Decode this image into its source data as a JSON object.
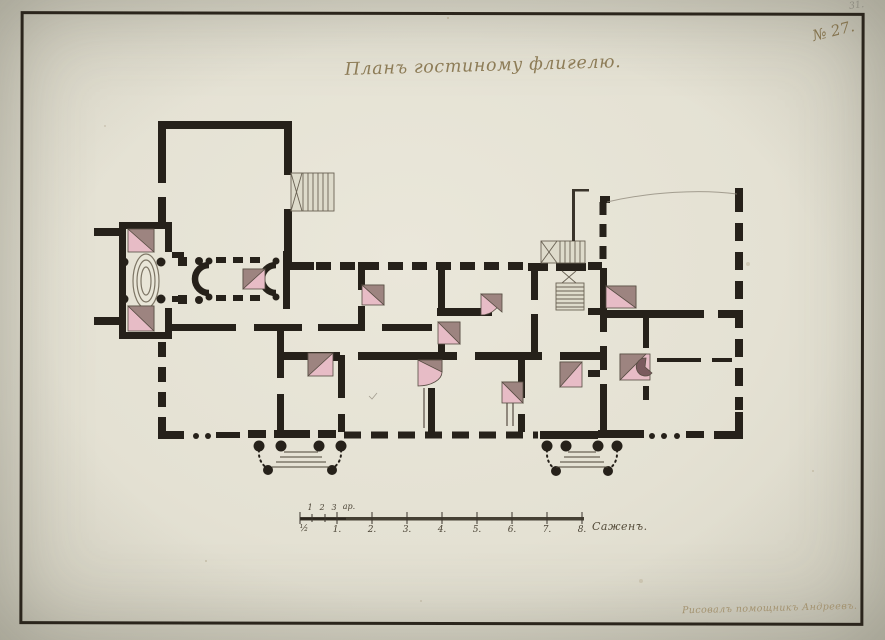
{
  "annotations": {
    "pencil_number": "31.",
    "catalog_number": "№ 27.",
    "title": "Планъ гостиному флигелю.",
    "signature": "Рисовалъ помощникъ Андреевъ."
  },
  "scale_bar": {
    "arshin_labels": [
      "1",
      "2",
      "3"
    ],
    "arshin_unit": "ар.",
    "sazhen_labels": [
      "½",
      "1.",
      "2.",
      "3.",
      "4.",
      "5.",
      "6.",
      "7.",
      "8."
    ],
    "unit_label": "Саженъ."
  },
  "drawing": {
    "kind": "architectural floor plan, ink and watercolor on laid paper",
    "stove_count": 12,
    "porch_count": 2,
    "staircase_count": 4
  },
  "palette": {
    "paper": "#e4e1d4",
    "ink": "#26211a",
    "stove_pink": "#e7bcc6",
    "stove_shadow": "#9d8480",
    "faded_ink": "#8d7c57"
  }
}
